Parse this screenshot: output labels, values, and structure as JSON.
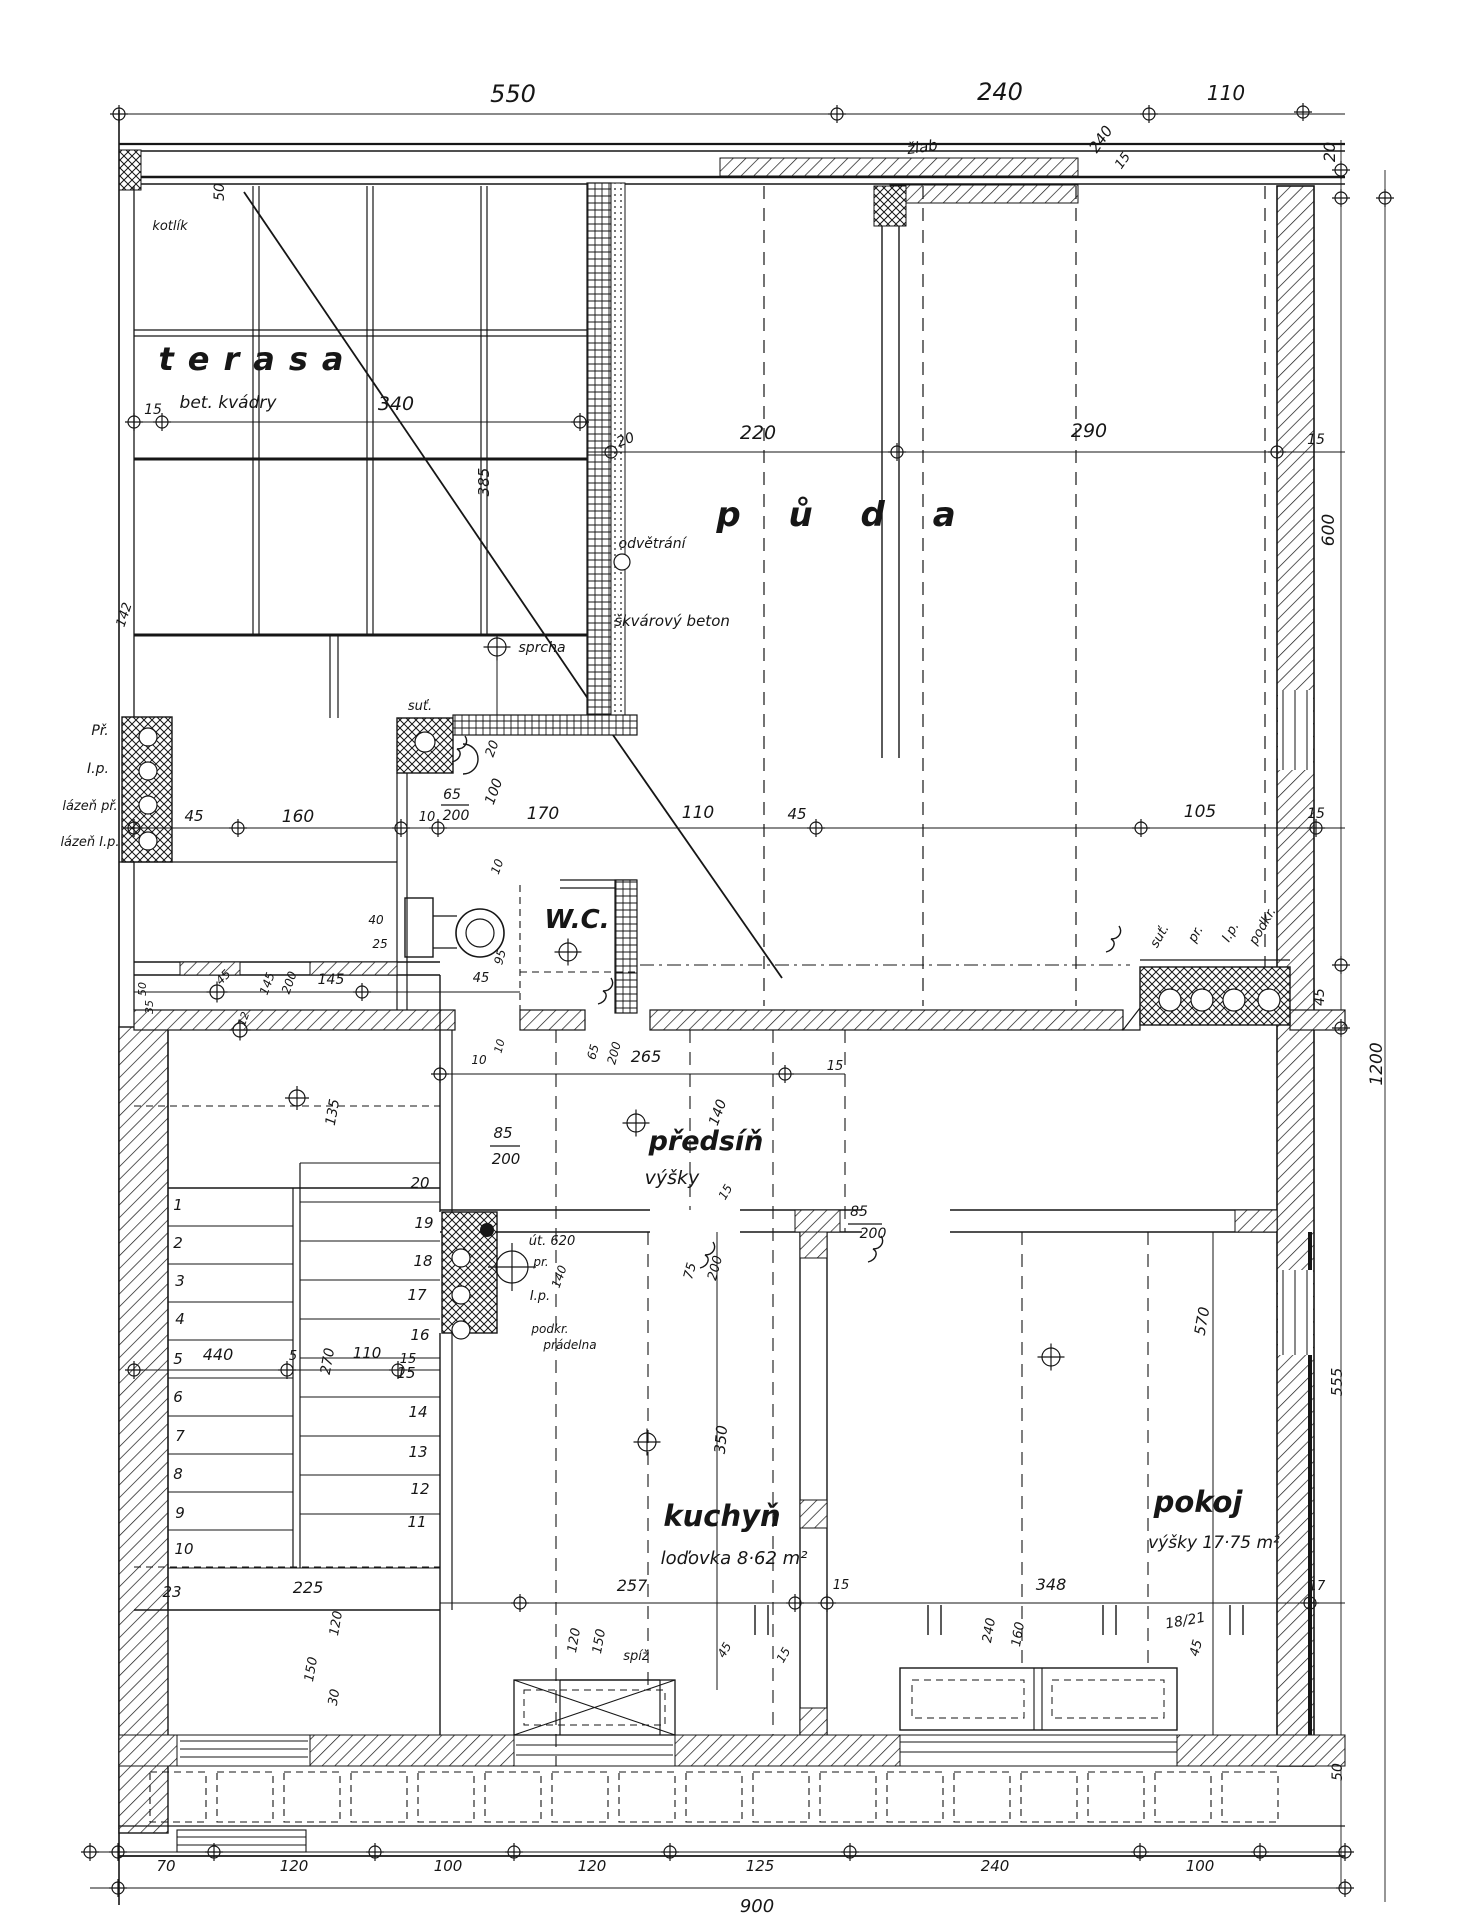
{
  "meta": {
    "document_type": "architectural floor plan, hand-drawn ink on paper",
    "language": "cs",
    "colors": {
      "ink": "#161616",
      "paper": "#ffffff"
    }
  },
  "rooms": {
    "terasa": {
      "name": "terasa",
      "note": "bet. kvádry"
    },
    "puda": {
      "name": "p ů d a"
    },
    "wc": {
      "name": "W.C."
    },
    "predsin": {
      "name": "předsíň",
      "note": "výšky"
    },
    "kuchyn": {
      "name": "kuchyň",
      "note": "loďovka 8·62 m²"
    },
    "pokoj": {
      "name": "pokoj",
      "note": "výšky 17·75 m²"
    }
  },
  "totals": {
    "width_bottom": "900",
    "height_right": "1200"
  },
  "labels": [
    [
      "550",
      513,
      102,
      0,
      24
    ],
    [
      "240",
      1000,
      100,
      0,
      24
    ],
    [
      "110",
      1226,
      100,
      0,
      20
    ],
    [
      "žlab",
      923,
      152,
      -8,
      15
    ],
    [
      "240",
      1105,
      142,
      -55,
      15
    ],
    [
      "15",
      1126,
      163,
      -55,
      13
    ],
    [
      "20",
      1335,
      152,
      -90,
      16
    ],
    [
      "50",
      224,
      192,
      -90,
      14
    ],
    [
      "kotlík",
      170,
      230,
      0,
      13
    ],
    [
      "15",
      153,
      414,
      0,
      14
    ],
    [
      "340",
      396,
      410,
      0,
      19
    ],
    [
      "385",
      489,
      482,
      -90,
      15
    ],
    [
      "142",
      128,
      616,
      -72,
      13
    ],
    [
      "20",
      627,
      444,
      -20,
      14
    ],
    [
      "220",
      758,
      439,
      0,
      19
    ],
    [
      "290",
      1089,
      437,
      0,
      19
    ],
    [
      "15",
      1316,
      444,
      0,
      14
    ],
    [
      "odvětrání",
      652,
      548,
      0,
      14
    ],
    [
      "škvárový beton",
      672,
      626,
      0,
      15
    ],
    [
      "sprcha",
      542,
      652,
      0,
      14
    ],
    [
      "suť.",
      420,
      710,
      0,
      13
    ],
    [
      "600",
      1334,
      530,
      -90,
      17
    ],
    [
      "45",
      1324,
      997,
      -90,
      14
    ],
    [
      "1200",
      1382,
      1064,
      -90,
      17
    ],
    [
      "555",
      1342,
      1382,
      -90,
      15
    ],
    [
      "50",
      1342,
      1772,
      -90,
      14
    ],
    [
      "suť.",
      1163,
      938,
      -60,
      13
    ],
    [
      "pr.",
      1199,
      936,
      -60,
      13
    ],
    [
      "I.p.",
      1234,
      934,
      -60,
      13
    ],
    [
      "podkr.",
      1266,
      928,
      -60,
      13
    ],
    [
      "45",
      194,
      821,
      0,
      15
    ],
    [
      "160",
      298,
      822,
      0,
      17
    ],
    [
      "10",
      427,
      821,
      0,
      13
    ],
    [
      "65",
      452,
      799,
      0,
      14
    ],
    [
      "200",
      456,
      820,
      0,
      14
    ],
    [
      "20",
      496,
      750,
      -70,
      13
    ],
    [
      "100",
      498,
      793,
      -70,
      14
    ],
    [
      "10",
      501,
      868,
      -70,
      12
    ],
    [
      "170",
      543,
      819,
      0,
      17
    ],
    [
      "110",
      698,
      818,
      0,
      17
    ],
    [
      "45",
      797,
      819,
      0,
      15
    ],
    [
      "105",
      1200,
      817,
      0,
      17
    ],
    [
      "15",
      1316,
      818,
      0,
      14
    ],
    [
      "Př.",
      100,
      735,
      0,
      14
    ],
    [
      "I.p.",
      98,
      773,
      0,
      14
    ],
    [
      "lázeň př.",
      90,
      810,
      0,
      13
    ],
    [
      "lázeň I.p.",
      90,
      846,
      0,
      13
    ],
    [
      "40",
      376,
      924,
      0,
      12
    ],
    [
      "25",
      380,
      948,
      0,
      12
    ],
    [
      "95",
      504,
      958,
      -75,
      12
    ],
    [
      "45",
      481,
      982,
      0,
      13
    ],
    [
      "145",
      331,
      984,
      0,
      14
    ],
    [
      "145",
      271,
      985,
      -70,
      12
    ],
    [
      "200",
      293,
      984,
      -70,
      12
    ],
    [
      "45",
      226,
      980,
      -45,
      12
    ],
    [
      "50",
      146,
      989,
      -90,
      11
    ],
    [
      "35",
      153,
      1007,
      -90,
      11
    ],
    [
      "12",
      247,
      1020,
      -70,
      11
    ],
    [
      "135",
      337,
      1113,
      -80,
      14
    ],
    [
      "65",
      597,
      1053,
      -75,
      12
    ],
    [
      "200",
      618,
      1054,
      -75,
      12
    ],
    [
      "10",
      503,
      1047,
      -75,
      11
    ],
    [
      "10",
      479,
      1064,
      0,
      12
    ],
    [
      "265",
      646,
      1062,
      0,
      16
    ],
    [
      "15",
      835,
      1070,
      0,
      13
    ],
    [
      "140",
      722,
      1114,
      -70,
      14
    ],
    [
      "15",
      729,
      1194,
      -60,
      12
    ],
    [
      "85",
      503,
      1138,
      0,
      15
    ],
    [
      "200",
      506,
      1164,
      0,
      15
    ],
    [
      "85",
      859,
      1216,
      0,
      14
    ],
    [
      "200",
      873,
      1238,
      0,
      14
    ],
    [
      "75",
      694,
      1272,
      -75,
      13
    ],
    [
      "200",
      719,
      1269,
      -75,
      13
    ],
    [
      "út. 620",
      552,
      1245,
      0,
      13
    ],
    [
      "pr.",
      541,
      1266,
      0,
      12
    ],
    [
      "140",
      563,
      1278,
      -70,
      12
    ],
    [
      "I.p.",
      540,
      1300,
      0,
      13
    ],
    [
      "podkr.",
      550,
      1333,
      0,
      12
    ],
    [
      "prádelna",
      570,
      1349,
      0,
      12
    ],
    [
      "440",
      218,
      1360,
      0,
      16
    ],
    [
      "5",
      293,
      1360,
      0,
      13
    ],
    [
      "270",
      332,
      1362,
      -80,
      14
    ],
    [
      "110",
      367,
      1358,
      0,
      15
    ],
    [
      "15",
      408,
      1363,
      0,
      13
    ],
    [
      "225",
      308,
      1593,
      0,
      16
    ],
    [
      "120",
      340,
      1624,
      -80,
      13
    ],
    [
      "150",
      315,
      1670,
      -80,
      13
    ],
    [
      "30",
      338,
      1698,
      -80,
      13
    ],
    [
      "350",
      726,
      1440,
      -85,
      15
    ],
    [
      "257",
      632,
      1591,
      0,
      16
    ],
    [
      "15",
      841,
      1589,
      0,
      13
    ],
    [
      "120",
      578,
      1641,
      -80,
      13
    ],
    [
      "150",
      603,
      1642,
      -80,
      13
    ],
    [
      "spíž",
      636,
      1660,
      0,
      13
    ],
    [
      "45",
      728,
      1652,
      -60,
      12
    ],
    [
      "15",
      787,
      1657,
      -60,
      12
    ],
    [
      "348",
      1051,
      1590,
      0,
      16
    ],
    [
      "240",
      993,
      1631,
      -80,
      13
    ],
    [
      "160",
      1022,
      1635,
      -80,
      13
    ],
    [
      "18/21",
      1186,
      1625,
      -10,
      14
    ],
    [
      "45",
      1200,
      1649,
      -75,
      13
    ],
    [
      "17",
      1317,
      1590,
      0,
      13
    ],
    [
      "570",
      1207,
      1322,
      -80,
      15
    ],
    [
      "70",
      166,
      1871,
      0,
      15
    ],
    [
      "120",
      294,
      1871,
      0,
      15
    ],
    [
      "100",
      448,
      1871,
      0,
      15
    ],
    [
      "120",
      592,
      1871,
      0,
      15
    ],
    [
      "125",
      760,
      1871,
      0,
      15
    ],
    [
      "240",
      995,
      1871,
      0,
      15
    ],
    [
      "100",
      1200,
      1871,
      0,
      15
    ],
    [
      "1",
      178,
      1210,
      0,
      15
    ],
    [
      "2",
      178,
      1248,
      0,
      15
    ],
    [
      "3",
      180,
      1286,
      0,
      15
    ],
    [
      "4",
      180,
      1324,
      0,
      15
    ],
    [
      "5",
      178,
      1364,
      0,
      15
    ],
    [
      "6",
      178,
      1402,
      0,
      15
    ],
    [
      "7",
      180,
      1441,
      0,
      15
    ],
    [
      "8",
      178,
      1479,
      0,
      15
    ],
    [
      "9",
      180,
      1518,
      0,
      15
    ],
    [
      "10",
      184,
      1554,
      0,
      15
    ],
    [
      "23",
      172,
      1597,
      0,
      15
    ],
    [
      "20",
      420,
      1188,
      0,
      15
    ],
    [
      "19",
      424,
      1228,
      0,
      15
    ],
    [
      "18",
      423,
      1266,
      0,
      15
    ],
    [
      "17",
      417,
      1300,
      0,
      15
    ],
    [
      "16",
      420,
      1340,
      0,
      15
    ],
    [
      "15",
      406,
      1378,
      0,
      15
    ],
    [
      "14",
      418,
      1417,
      0,
      15
    ],
    [
      "13",
      418,
      1457,
      0,
      15
    ],
    [
      "12",
      420,
      1494,
      0,
      15
    ],
    [
      "11",
      417,
      1527,
      0,
      15
    ]
  ],
  "markers": [
    [
      119,
      114,
      6
    ],
    [
      837,
      114,
      6
    ],
    [
      1149,
      114,
      6
    ],
    [
      1303,
      112,
      6
    ],
    [
      1341,
      170,
      6
    ],
    [
      1341,
      198,
      6
    ],
    [
      1385,
      198,
      6
    ],
    [
      1341,
      965,
      6
    ],
    [
      1341,
      1028,
      6
    ],
    [
      611,
      452,
      6
    ],
    [
      897,
      452,
      6
    ],
    [
      1277,
      452,
      6
    ],
    [
      134,
      422,
      6
    ],
    [
      162,
      422,
      6
    ],
    [
      580,
      422,
      6
    ],
    [
      134,
      828,
      6
    ],
    [
      238,
      828,
      6
    ],
    [
      401,
      828,
      6
    ],
    [
      438,
      828,
      6
    ],
    [
      816,
      828,
      6
    ],
    [
      1141,
      828,
      6
    ],
    [
      1316,
      828,
      6
    ],
    [
      217,
      992,
      7
    ],
    [
      240,
      1030,
      7
    ],
    [
      362,
      992,
      6
    ],
    [
      568,
      952,
      9
    ],
    [
      497,
      647,
      9
    ],
    [
      636,
      1123,
      9
    ],
    [
      440,
      1074,
      6
    ],
    [
      785,
      1074,
      6
    ],
    [
      297,
      1098,
      8
    ],
    [
      134,
      1370,
      6
    ],
    [
      287,
      1370,
      6
    ],
    [
      398,
      1370,
      6
    ],
    [
      647,
      1442,
      9
    ],
    [
      520,
      1603,
      6
    ],
    [
      795,
      1603,
      6
    ],
    [
      827,
      1603,
      6
    ],
    [
      1310,
      1603,
      6
    ],
    [
      1051,
      1357,
      9
    ],
    [
      512,
      1267,
      16
    ],
    [
      90,
      1852,
      6
    ],
    [
      118,
      1852,
      6
    ],
    [
      214,
      1852,
      6
    ],
    [
      375,
      1852,
      6
    ],
    [
      514,
      1852,
      6
    ],
    [
      670,
      1852,
      6
    ],
    [
      850,
      1852,
      6
    ],
    [
      1140,
      1852,
      6
    ],
    [
      1260,
      1852,
      6
    ],
    [
      1345,
      1852,
      6
    ],
    [
      118,
      1888,
      6
    ],
    [
      1345,
      1888,
      6
    ]
  ],
  "circles": [
    [
      622,
      562,
      8
    ],
    [
      425,
      742,
      10
    ],
    [
      148,
      737,
      9
    ],
    [
      148,
      771,
      9
    ],
    [
      148,
      805,
      9
    ],
    [
      148,
      841,
      9
    ],
    [
      1170,
      1000,
      11
    ],
    [
      1202,
      1000,
      11
    ],
    [
      1234,
      1000,
      11
    ],
    [
      1269,
      1000,
      11
    ],
    [
      461,
      1258,
      9
    ],
    [
      461,
      1295,
      9
    ],
    [
      461,
      1330,
      9
    ]
  ],
  "dots": [
    [
      487,
      1230,
      7
    ]
  ]
}
